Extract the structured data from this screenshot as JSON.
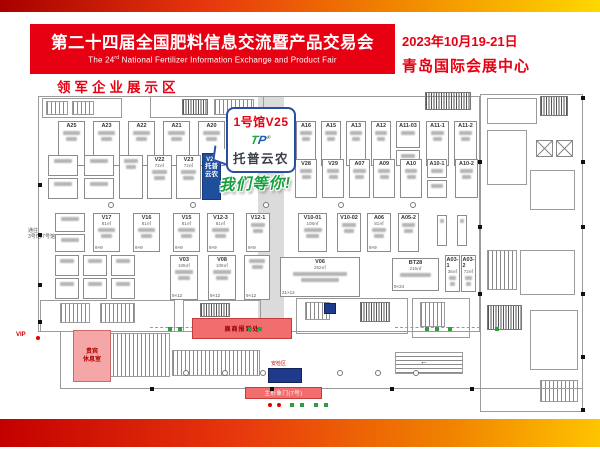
{
  "header": {
    "title": "第二十四届全国肥料信息交流暨产品交易会",
    "subtitle_pre": "The 24",
    "subtitle_sup": "rd",
    "subtitle_rest": " National Fertilizer Information Exchange and Product Fair",
    "date": "2023年10月19-21日",
    "venue": "青岛国际会展中心"
  },
  "section_label": "领军企业展示区",
  "callout": {
    "hall_booth": "1号馆V25",
    "logo_t": "T",
    "logo_p": "P",
    "logo_reg": "®",
    "brand": "托普云农",
    "slogan": "我们等你!"
  },
  "labels": {
    "vip": "VIP",
    "vip_lounge_l1": "贵宾",
    "vip_lounge_l2": "休息室",
    "registration": "展商报到处",
    "security": "安检区",
    "gate": "主形象门(7号)",
    "corridor_l1": "通往",
    "corridor_l2": "3号馆/7号馆",
    "escalator_arrow": "←"
  },
  "colors": {
    "accent_red": "#e60012",
    "gradient_left": "#c30000",
    "gradient_mid": "#f08300",
    "gradient_right": "#ffd800",
    "highlight_booth_blue": "#1f4e9c",
    "slogan_green": "#17a13c",
    "service_pink": "#f26d6d",
    "security_navy": "#1e3a8a"
  },
  "floorplan": {
    "booths": [
      {
        "i": "A25",
        "x": 58,
        "y": 121,
        "w": 27,
        "h": 45
      },
      {
        "i": "A23",
        "x": 93,
        "y": 121,
        "w": 27,
        "h": 45
      },
      {
        "i": "A22",
        "x": 128,
        "y": 121,
        "w": 27,
        "h": 45
      },
      {
        "i": "A21",
        "x": 163,
        "y": 121,
        "w": 27,
        "h": 45
      },
      {
        "i": "A20",
        "x": 198,
        "y": 121,
        "w": 27,
        "h": 45
      },
      {
        "i": "A19",
        "x": 233,
        "y": 121,
        "w": 24,
        "h": 45
      },
      {
        "i": "A16",
        "x": 296,
        "y": 121,
        "w": 20,
        "h": 45
      },
      {
        "i": "A15",
        "x": 321,
        "y": 121,
        "w": 20,
        "h": 45
      },
      {
        "i": "A13",
        "x": 346,
        "y": 121,
        "w": 20,
        "h": 45
      },
      {
        "i": "A12",
        "x": 371,
        "y": 121,
        "w": 20,
        "h": 45
      },
      {
        "i": "A11-03",
        "x": 396,
        "y": 121,
        "w": 24,
        "h": 27
      },
      {
        "i": "",
        "x": 396,
        "y": 150,
        "w": 24,
        "h": 16
      },
      {
        "i": "A11-1",
        "x": 426,
        "y": 121,
        "w": 23,
        "h": 45
      },
      {
        "i": "A11-2",
        "x": 454,
        "y": 121,
        "w": 23,
        "h": 45
      },
      {
        "i": "",
        "x": 48,
        "y": 155,
        "w": 30,
        "h": 21
      },
      {
        "i": "",
        "x": 48,
        "y": 178,
        "w": 30,
        "h": 21
      },
      {
        "i": "",
        "x": 84,
        "y": 155,
        "w": 30,
        "h": 21
      },
      {
        "i": "",
        "x": 84,
        "y": 178,
        "w": 30,
        "h": 21
      },
      {
        "i": "",
        "x": 119,
        "y": 155,
        "w": 24,
        "h": 44
      },
      {
        "i": "V22",
        "x": 147,
        "y": 155,
        "w": 25,
        "h": 44,
        "s": "72㎡"
      },
      {
        "i": "V23",
        "x": 176,
        "y": 155,
        "w": 25,
        "h": 44,
        "s": "72㎡"
      },
      {
        "i": "V25",
        "x": 202,
        "y": 153,
        "w": 19,
        "h": 47,
        "st": "blue",
        "ln": [
          "托普",
          "云农"
        ]
      },
      {
        "i": "V28",
        "x": 295,
        "y": 159,
        "w": 22,
        "h": 39
      },
      {
        "i": "V29",
        "x": 322,
        "y": 159,
        "w": 22,
        "h": 39
      },
      {
        "i": "A07",
        "x": 349,
        "y": 159,
        "w": 21,
        "h": 39
      },
      {
        "i": "A09",
        "x": 373,
        "y": 159,
        "w": 22,
        "h": 39
      },
      {
        "i": "A10",
        "x": 400,
        "y": 159,
        "w": 22,
        "h": 39
      },
      {
        "i": "A10-1",
        "x": 427,
        "y": 159,
        "w": 20,
        "h": 19
      },
      {
        "i": "",
        "x": 427,
        "y": 180,
        "w": 20,
        "h": 18
      },
      {
        "i": "A10-2",
        "x": 455,
        "y": 159,
        "w": 23,
        "h": 39
      },
      {
        "i": "",
        "x": 55,
        "y": 213,
        "w": 30,
        "h": 19
      },
      {
        "i": "",
        "x": 55,
        "y": 234,
        "w": 30,
        "h": 18
      },
      {
        "i": "V17",
        "x": 93,
        "y": 213,
        "w": 27,
        "h": 39,
        "s": "81㎡",
        "d": "9×9"
      },
      {
        "i": "V16",
        "x": 133,
        "y": 213,
        "w": 27,
        "h": 39,
        "s": "81㎡",
        "d": "9×9"
      },
      {
        "i": "V15",
        "x": 173,
        "y": 213,
        "w": 27,
        "h": 39,
        "s": "81㎡",
        "d": "9×9"
      },
      {
        "i": "V12-3",
        "x": 207,
        "y": 213,
        "w": 27,
        "h": 39,
        "s": "81㎡",
        "d": "9×9"
      },
      {
        "i": "V12-1",
        "x": 246,
        "y": 213,
        "w": 24,
        "h": 39,
        "d": "9×9"
      },
      {
        "i": "V10-01",
        "x": 298,
        "y": 213,
        "w": 29,
        "h": 39,
        "s": "108㎡"
      },
      {
        "i": "V10-02",
        "x": 337,
        "y": 213,
        "w": 24,
        "h": 39
      },
      {
        "i": "A06",
        "x": 367,
        "y": 213,
        "w": 24,
        "h": 39,
        "s": "81㎡",
        "d": "9×9"
      },
      {
        "i": "A05-2",
        "x": 398,
        "y": 213,
        "w": 21,
        "h": 39
      },
      {
        "i": "",
        "x": 437,
        "y": 215,
        "w": 10,
        "h": 31
      },
      {
        "i": "",
        "x": 457,
        "y": 215,
        "w": 10,
        "h": 31
      },
      {
        "i": "",
        "x": 55,
        "y": 255,
        "w": 24,
        "h": 21
      },
      {
        "i": "",
        "x": 55,
        "y": 278,
        "w": 24,
        "h": 21
      },
      {
        "i": "",
        "x": 83,
        "y": 255,
        "w": 24,
        "h": 21
      },
      {
        "i": "",
        "x": 83,
        "y": 278,
        "w": 24,
        "h": 21
      },
      {
        "i": "",
        "x": 111,
        "y": 255,
        "w": 24,
        "h": 21
      },
      {
        "i": "",
        "x": 111,
        "y": 278,
        "w": 24,
        "h": 21
      },
      {
        "i": "V03",
        "x": 170,
        "y": 255,
        "w": 28,
        "h": 45,
        "s": "108㎡",
        "d": "9×12"
      },
      {
        "i": "V08",
        "x": 208,
        "y": 255,
        "w": 28,
        "h": 45,
        "s": "108㎡",
        "d": "9×12"
      },
      {
        "i": "",
        "x": 244,
        "y": 255,
        "w": 26,
        "h": 45,
        "d": "9×12"
      },
      {
        "i": "V06",
        "x": 280,
        "y": 257,
        "w": 80,
        "h": 40,
        "s": "252㎡",
        "d": "21×12"
      },
      {
        "i": "BT28",
        "x": 392,
        "y": 258,
        "w": 47,
        "h": 33,
        "s": "216㎡",
        "d": "9×24"
      },
      {
        "i": "A03-1",
        "x": 445,
        "y": 255,
        "w": 15,
        "h": 37,
        "s": "36㎡"
      },
      {
        "i": "A03-2",
        "x": 461,
        "y": 255,
        "w": 15,
        "h": 37,
        "s": "72㎡"
      }
    ],
    "structures": [
      {
        "t": "gray",
        "x": 258,
        "y": 96,
        "w": 26,
        "h": 236
      },
      {
        "t": "box",
        "x": 38,
        "y": 96,
        "w": 442,
        "h": 236
      },
      {
        "t": "box",
        "x": 42,
        "y": 98,
        "w": 80,
        "h": 20
      },
      {
        "t": "vs",
        "x": 46,
        "y": 101,
        "w": 22,
        "h": 14
      },
      {
        "t": "vs",
        "x": 72,
        "y": 101,
        "w": 22,
        "h": 14
      },
      {
        "t": "box",
        "x": 150,
        "y": 96,
        "w": 114,
        "h": 22
      },
      {
        "t": "ds",
        "x": 182,
        "y": 99,
        "w": 26,
        "h": 16
      },
      {
        "t": "vs",
        "x": 214,
        "y": 99,
        "w": 40,
        "h": 16
      },
      {
        "t": "dash",
        "x": 264,
        "y": 96,
        "w": 160,
        "h": 1
      },
      {
        "t": "ds",
        "x": 425,
        "y": 92,
        "w": 46,
        "h": 18
      },
      {
        "t": "box",
        "x": 480,
        "y": 94,
        "w": 103,
        "h": 318
      },
      {
        "t": "box",
        "x": 487,
        "y": 98,
        "w": 50,
        "h": 26
      },
      {
        "t": "ds",
        "x": 540,
        "y": 96,
        "w": 28,
        "h": 20
      },
      {
        "t": "box",
        "x": 487,
        "y": 130,
        "w": 40,
        "h": 55
      },
      {
        "t": "x",
        "x": 536,
        "y": 140,
        "w": 17,
        "h": 17
      },
      {
        "t": "x",
        "x": 556,
        "y": 140,
        "w": 17,
        "h": 17
      },
      {
        "t": "box",
        "x": 530,
        "y": 170,
        "w": 45,
        "h": 40
      },
      {
        "t": "vs",
        "x": 487,
        "y": 250,
        "w": 30,
        "h": 40
      },
      {
        "t": "box",
        "x": 520,
        "y": 250,
        "w": 55,
        "h": 45
      },
      {
        "t": "ds",
        "x": 487,
        "y": 305,
        "w": 35,
        "h": 25
      },
      {
        "t": "box",
        "x": 530,
        "y": 310,
        "w": 48,
        "h": 60
      },
      {
        "t": "vs",
        "x": 540,
        "y": 380,
        "w": 38,
        "h": 22
      },
      {
        "t": "box",
        "x": 40,
        "y": 300,
        "w": 135,
        "h": 32
      },
      {
        "t": "vs",
        "x": 60,
        "y": 303,
        "w": 30,
        "h": 20
      },
      {
        "t": "vs",
        "x": 100,
        "y": 303,
        "w": 35,
        "h": 20
      },
      {
        "t": "box",
        "x": 183,
        "y": 300,
        "w": 78,
        "h": 32
      },
      {
        "t": "ds",
        "x": 200,
        "y": 303,
        "w": 30,
        "h": 14
      },
      {
        "t": "box",
        "x": 296,
        "y": 298,
        "w": 112,
        "h": 36
      },
      {
        "t": "vs",
        "x": 305,
        "y": 302,
        "w": 25,
        "h": 18
      },
      {
        "t": "ds",
        "x": 360,
        "y": 302,
        "w": 30,
        "h": 20
      },
      {
        "t": "box",
        "x": 412,
        "y": 298,
        "w": 58,
        "h": 40
      },
      {
        "t": "vs",
        "x": 420,
        "y": 302,
        "w": 25,
        "h": 25
      },
      {
        "t": "vs",
        "x": 100,
        "y": 333,
        "w": 70,
        "h": 44
      },
      {
        "t": "vs",
        "x": 172,
        "y": 350,
        "w": 88,
        "h": 26
      },
      {
        "t": "hs",
        "x": 395,
        "y": 352,
        "w": 68,
        "h": 22
      },
      {
        "t": "hl",
        "x": 60,
        "y": 388,
        "w": 523,
        "h": 1
      },
      {
        "t": "vl",
        "x": 60,
        "y": 332,
        "w": 1,
        "h": 56
      },
      {
        "t": "dash",
        "x": 150,
        "y": 327,
        "w": 120,
        "h": 1
      },
      {
        "t": "dash",
        "x": 395,
        "y": 327,
        "w": 85,
        "h": 1
      }
    ],
    "circles": [
      [
        108,
        202
      ],
      [
        190,
        202
      ],
      [
        263,
        202
      ],
      [
        338,
        202
      ],
      [
        410,
        202
      ],
      [
        183,
        370
      ],
      [
        222,
        370
      ],
      [
        260,
        370
      ],
      [
        337,
        370
      ],
      [
        375,
        370
      ],
      [
        413,
        370
      ]
    ],
    "squares": [
      [
        38,
        183
      ],
      [
        38,
        233
      ],
      [
        38,
        283
      ],
      [
        38,
        320
      ],
      [
        478,
        160
      ],
      [
        478,
        225
      ],
      [
        478,
        292
      ],
      [
        581,
        96
      ],
      [
        581,
        160
      ],
      [
        581,
        225
      ],
      [
        581,
        292
      ],
      [
        581,
        355
      ],
      [
        581,
        408
      ],
      [
        150,
        387
      ],
      [
        270,
        387
      ],
      [
        390,
        387
      ],
      [
        470,
        387
      ]
    ],
    "markers_green": [
      [
        168,
        327
      ],
      [
        178,
        327
      ],
      [
        248,
        327
      ],
      [
        258,
        327
      ],
      [
        425,
        327
      ],
      [
        435,
        327
      ],
      [
        448,
        327
      ],
      [
        495,
        327
      ],
      [
        290,
        403
      ],
      [
        300,
        403
      ],
      [
        314,
        403
      ],
      [
        324,
        403
      ]
    ],
    "markers_red": [
      [
        36,
        336
      ],
      [
        268,
        403
      ],
      [
        277,
        403
      ]
    ]
  }
}
